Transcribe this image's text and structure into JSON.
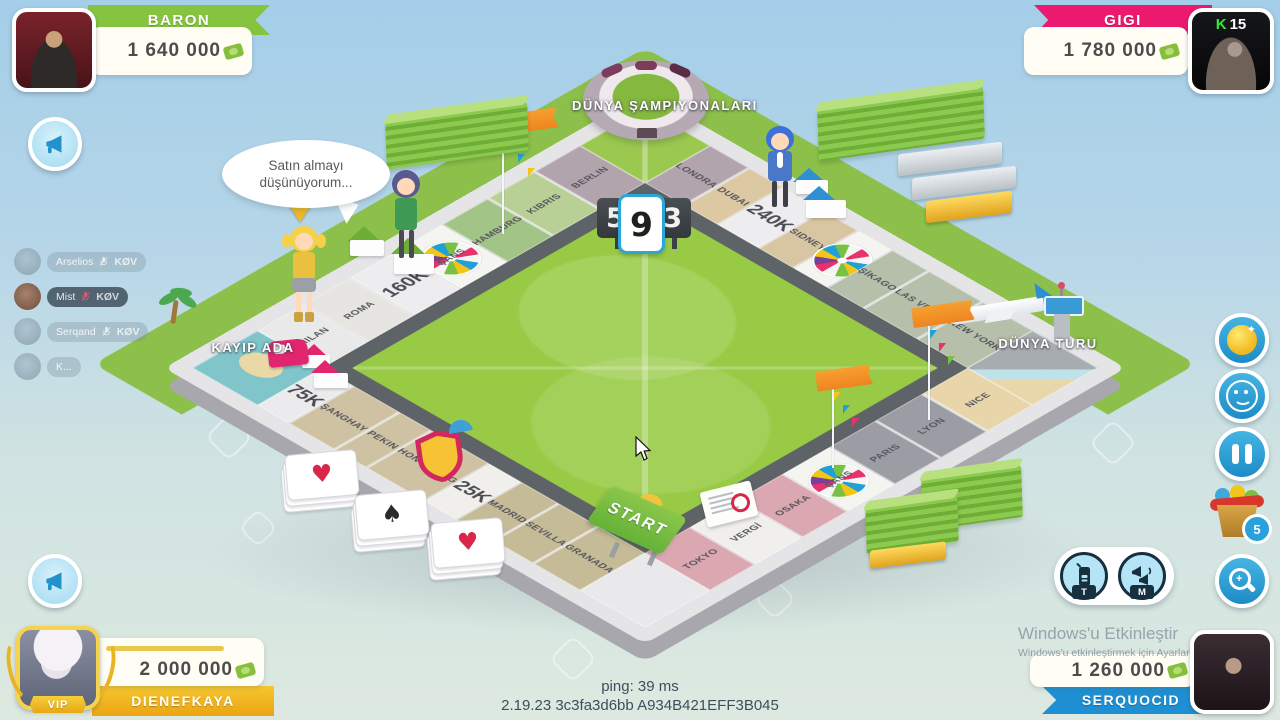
{
  "players": {
    "top_left": {
      "name": "BARON",
      "money": "1 640 000",
      "accent": "#86c440"
    },
    "top_right": {
      "name": "GIGI",
      "money": "1 780 000",
      "accent": "#ec1a6e",
      "badge_letter": "K",
      "badge_level": "15"
    },
    "bottom_left": {
      "name": "DIENEFKAYA",
      "money": "2 000 000",
      "accent": "#f0b81e",
      "vip_label": "VIP"
    },
    "bottom_right": {
      "name": "SERQUOCID",
      "money": "1 260 000",
      "accent": "#1e8fd2"
    }
  },
  "board": {
    "corner_top": "DÜNYA ŞAMPIYONALARI",
    "corner_right": "DÜNYA TURU",
    "corner_bottom": "START",
    "corner_left": "KAYIP ADA",
    "edges": {
      "left": [
        {
          "label": "BERLIN",
          "bg": "#b2a4ad"
        },
        {
          "label": "KIBRIS",
          "bg": "#b8cf96"
        },
        {
          "label": "HAMBURG",
          "bg": "#a3c487"
        },
        {
          "label": "ŞANS",
          "bg": "#f4f4f1",
          "wheel": true
        },
        {
          "label": "160K",
          "bg": "#ededef",
          "big": true
        },
        {
          "label": "ROMA",
          "bg": "#e6e5e1"
        },
        {
          "label": "MILAN",
          "bg": "#e9e9ea"
        }
      ],
      "top": [
        {
          "label": "LONDRA",
          "bg": "#b2a4ad"
        },
        {
          "label": "DUBAI",
          "bg": "#dcc9a4"
        },
        {
          "label": "240K",
          "bg": "#ededef",
          "big": true
        },
        {
          "label": "SIDNEY",
          "bg": "#d8c6a3"
        },
        {
          "label": "ŞANS",
          "bg": "#f4f4f1",
          "wheel": true
        },
        {
          "label": "ŞİKAGO",
          "bg": "#b5bfa9"
        },
        {
          "label": "LAS VEGAS",
          "bg": "#b5bfa9"
        },
        {
          "label": "NEW YORK",
          "bg": "#b5bfa9"
        }
      ],
      "right": [
        {
          "label": "NICE",
          "bg": "#e8d5a9"
        },
        {
          "label": "LYON",
          "bg": "#9c9ca4"
        },
        {
          "label": "PARIS",
          "bg": "#9c9ca4"
        },
        {
          "label": "ŞANS",
          "bg": "#f4f4f1",
          "wheel": true
        },
        {
          "label": "OSAKA",
          "bg": "#dba8b2"
        },
        {
          "label": "VERGİ",
          "bg": "#f0efec"
        },
        {
          "label": "TOKYO",
          "bg": "#dba8b2"
        }
      ],
      "bottom": [
        {
          "label": "75K",
          "bg": "#ebebed",
          "big": true
        },
        {
          "label": "ŞANGHAY",
          "bg": "#cfc2a2"
        },
        {
          "label": "PEKIN",
          "bg": "#cfc2a2"
        },
        {
          "label": "HONG KONG",
          "bg": "#cfc2a2"
        },
        {
          "label": "25K",
          "bg": "#f0efec",
          "big": true
        },
        {
          "label": "MADRID",
          "bg": "#c6bb97"
        },
        {
          "label": "SEVILLA",
          "bg": "#c6bb97"
        },
        {
          "label": "GRANADA",
          "bg": "#c6bb97"
        }
      ]
    }
  },
  "dice": {
    "value": "9",
    "left_digit": "5",
    "right_digit": "3"
  },
  "speech_bubble": {
    "line1": "Satın almayı",
    "line2": "düşünüyorum..."
  },
  "chat": {
    "items": [
      {
        "name": "Arselios",
        "tag": "KØV"
      },
      {
        "name": "Mist",
        "tag": "KØV",
        "highlight": true
      },
      {
        "name": "Serqand",
        "tag": "KØV"
      },
      {
        "name": "K..."
      }
    ]
  },
  "card_stacks": [
    "♥",
    "♠",
    "♥"
  ],
  "hud": {
    "bucket_badge": "5",
    "talk_tag": "T",
    "megaphone_tag": "M",
    "icons": {
      "left_buttons": "megaphone",
      "right_buttons": [
        "coin",
        "smiley",
        "pause",
        "prize-bucket",
        "zoom-in"
      ],
      "pill_buttons": [
        "walkie-talkie",
        "megaphone-duo"
      ]
    }
  },
  "status": {
    "ping": "ping: 39 ms",
    "build": "2.19.23 3c3fa3d6bb A934B421EFF3B045"
  },
  "watermark": {
    "line1": "Windows'u Etkinleştir",
    "line2": "Windows'u etkinleştirmek için Ayarlara gidin."
  }
}
